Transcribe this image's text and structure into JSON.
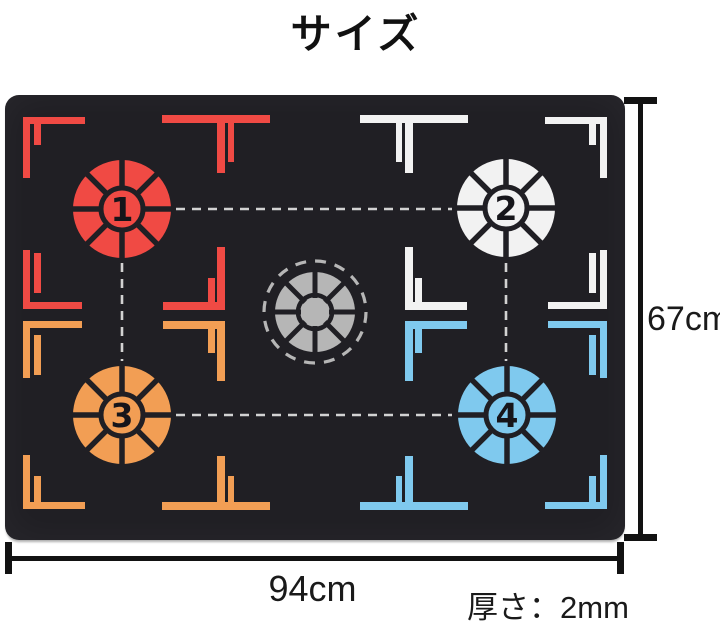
{
  "page": {
    "title": "サイズ"
  },
  "annotations": {
    "width_label": "94cm",
    "height_label": "67cm",
    "thickness_label": "厚さ：2mm"
  },
  "colors": {
    "red": "#f04a44",
    "orange": "#f29e54",
    "white": "#f2f2f2",
    "blue": "#7fc9ee",
    "gray": "#b6b6b6",
    "mat": "#201f24",
    "dash": "#d2d2d2",
    "number": "#16151a",
    "dimension": "#121212"
  },
  "mat": {
    "targets": [
      {
        "label": "1",
        "color": "red",
        "cx": 117,
        "cy": 114
      },
      {
        "label": "2",
        "color": "white",
        "cx": 501,
        "cy": 113
      },
      {
        "label": "3",
        "color": "orange",
        "cx": 117,
        "cy": 320
      },
      {
        "label": "4",
        "color": "blue",
        "cx": 502,
        "cy": 320
      }
    ],
    "center_target": {
      "cx": 310,
      "cy": 217,
      "color": "gray"
    },
    "guide_lines": [
      {
        "x1": 171,
        "y1": 114,
        "x2": 447,
        "y2": 114
      },
      {
        "x1": 171,
        "y1": 320,
        "x2": 447,
        "y2": 320
      },
      {
        "x1": 117,
        "y1": 168,
        "x2": 117,
        "y2": 266
      },
      {
        "x1": 501,
        "y1": 168,
        "x2": 501,
        "y2": 266
      }
    ],
    "markers": [
      [
        18,
        22,
        62,
        7,
        "red"
      ],
      [
        18,
        22,
        7,
        61,
        "red"
      ],
      [
        29,
        29,
        7,
        21,
        "red"
      ],
      [
        157,
        20,
        108,
        8,
        "red"
      ],
      [
        212,
        28,
        8,
        50,
        "red"
      ],
      [
        223,
        28,
        6,
        39,
        "red"
      ],
      [
        18,
        155,
        7,
        59,
        "red"
      ],
      [
        29,
        158,
        7,
        40,
        "red"
      ],
      [
        18,
        207,
        59,
        7,
        "red"
      ],
      [
        158,
        207,
        62,
        8,
        "red"
      ],
      [
        212,
        152,
        8,
        63,
        "red"
      ],
      [
        203,
        183,
        7,
        24,
        "red"
      ],
      [
        18,
        226,
        59,
        7,
        "orange"
      ],
      [
        18,
        226,
        7,
        57,
        "orange"
      ],
      [
        29,
        240,
        7,
        40,
        "orange"
      ],
      [
        158,
        226,
        62,
        8,
        "orange"
      ],
      [
        212,
        226,
        8,
        60,
        "orange"
      ],
      [
        203,
        234,
        7,
        24,
        "orange"
      ],
      [
        18,
        360,
        7,
        54,
        "orange"
      ],
      [
        29,
        381,
        7,
        26,
        "orange"
      ],
      [
        18,
        407,
        62,
        7,
        "orange"
      ],
      [
        157,
        407,
        108,
        8,
        "orange"
      ],
      [
        212,
        361,
        8,
        46,
        "orange"
      ],
      [
        223,
        381,
        6,
        26,
        "orange"
      ],
      [
        540,
        22,
        62,
        7,
        "white"
      ],
      [
        595,
        22,
        7,
        61,
        "white"
      ],
      [
        584,
        29,
        7,
        21,
        "white"
      ],
      [
        355,
        20,
        108,
        8,
        "white"
      ],
      [
        400,
        28,
        8,
        50,
        "white"
      ],
      [
        391,
        28,
        6,
        39,
        "white"
      ],
      [
        595,
        155,
        7,
        59,
        "white"
      ],
      [
        584,
        158,
        7,
        40,
        "white"
      ],
      [
        543,
        207,
        59,
        7,
        "white"
      ],
      [
        400,
        207,
        62,
        8,
        "white"
      ],
      [
        400,
        152,
        8,
        63,
        "white"
      ],
      [
        410,
        183,
        7,
        24,
        "white"
      ],
      [
        543,
        226,
        59,
        7,
        "blue"
      ],
      [
        595,
        226,
        7,
        57,
        "blue"
      ],
      [
        584,
        240,
        7,
        40,
        "blue"
      ],
      [
        400,
        226,
        62,
        8,
        "blue"
      ],
      [
        400,
        226,
        8,
        60,
        "blue"
      ],
      [
        410,
        234,
        7,
        24,
        "blue"
      ],
      [
        595,
        360,
        7,
        54,
        "blue"
      ],
      [
        584,
        381,
        7,
        26,
        "blue"
      ],
      [
        540,
        407,
        62,
        7,
        "blue"
      ],
      [
        355,
        407,
        108,
        8,
        "blue"
      ],
      [
        400,
        361,
        8,
        46,
        "blue"
      ],
      [
        391,
        381,
        6,
        26,
        "blue"
      ]
    ]
  }
}
